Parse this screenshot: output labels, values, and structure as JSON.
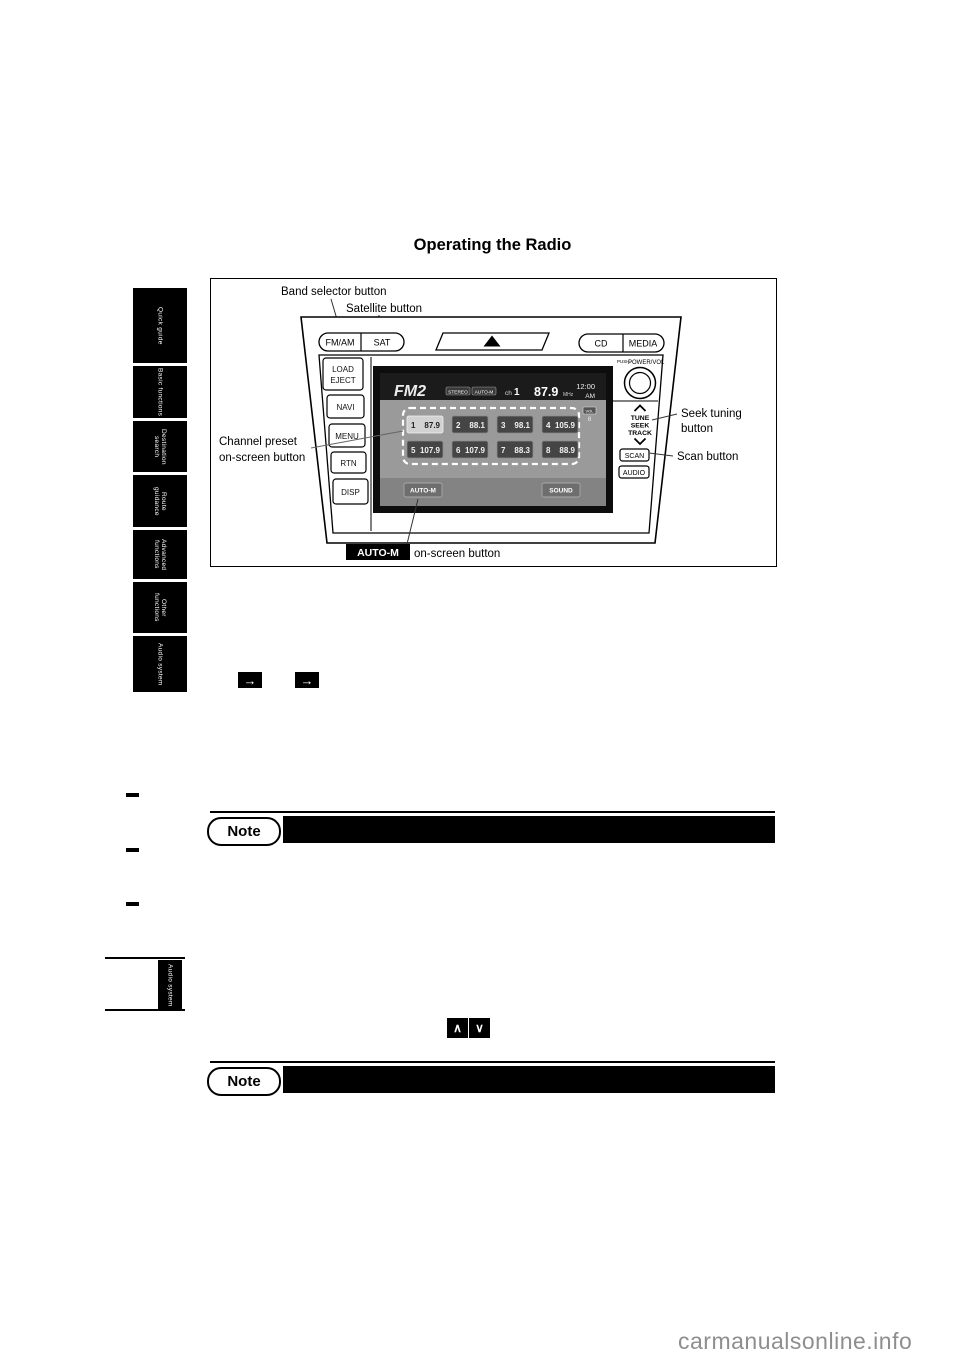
{
  "page": {
    "title": "Operating the Radio",
    "watermark": "carmanualsonline.info"
  },
  "colors": {
    "page_bg": "#ffffff",
    "tab_bg": "#000000",
    "note_bar": "#000000",
    "watermark": "#8e8e8e",
    "lcd_top_bar": "#1b1b1b",
    "lcd_body": "#9a9a9a"
  },
  "sidebar": {
    "tabs": [
      "Quick guide",
      "Basic functions",
      "Destination search",
      "Route guidance",
      "Advanced functions",
      "Other functions",
      "Audio system"
    ],
    "lower_tab": "Audio system"
  },
  "symbols": {
    "jump_arrow": "→",
    "seek_up": "∧",
    "seek_down": "∨"
  },
  "note": {
    "label": "Note"
  },
  "figure": {
    "annotations": {
      "band": "Band selector button",
      "satellite": "Satellite button",
      "channel_preset_line1": "Channel preset",
      "channel_preset_line2": "on-screen button",
      "seek_line1": "Seek tuning",
      "seek_line2": "button",
      "scan": "Scan button",
      "auto_m_badge": "AUTO-M",
      "auto_m_text": "on-screen button"
    },
    "panel": {
      "fm_am": "FM/AM",
      "sat": "SAT",
      "cd": "CD",
      "media": "MEDIA",
      "load": "LOAD",
      "eject": "EJECT",
      "navi": "NAVI",
      "menu": "MENU",
      "rtn": "RTN",
      "disp": "DISP",
      "push": "PUSH-",
      "power_vol": "POWER/VOL",
      "tune": "TUNE",
      "seek": "SEEK",
      "track": "TRACK",
      "scan": "SCAN",
      "audio": "AUDIO"
    },
    "screen": {
      "band": "FM2",
      "stereo_badge": "STEREO",
      "auto_badge": "AUTO-M",
      "ch_label": "ch",
      "ch_value": "1",
      "frequency": "87.9",
      "frequency_unit": "MHz",
      "time": "12:00",
      "ampm": "AM",
      "vol_label": "VOL",
      "vol_value": "8",
      "presets": [
        {
          "num": "1",
          "freq": "87.9"
        },
        {
          "num": "2",
          "freq": "88.1"
        },
        {
          "num": "3",
          "freq": "98.1"
        },
        {
          "num": "4",
          "freq": "105.9"
        },
        {
          "num": "5",
          "freq": "107.9"
        },
        {
          "num": "6",
          "freq": "107.9"
        },
        {
          "num": "7",
          "freq": "88.3"
        },
        {
          "num": "8",
          "freq": "88.9"
        }
      ],
      "auto_m_button": "AUTO-M",
      "sound_button": "SOUND"
    }
  }
}
